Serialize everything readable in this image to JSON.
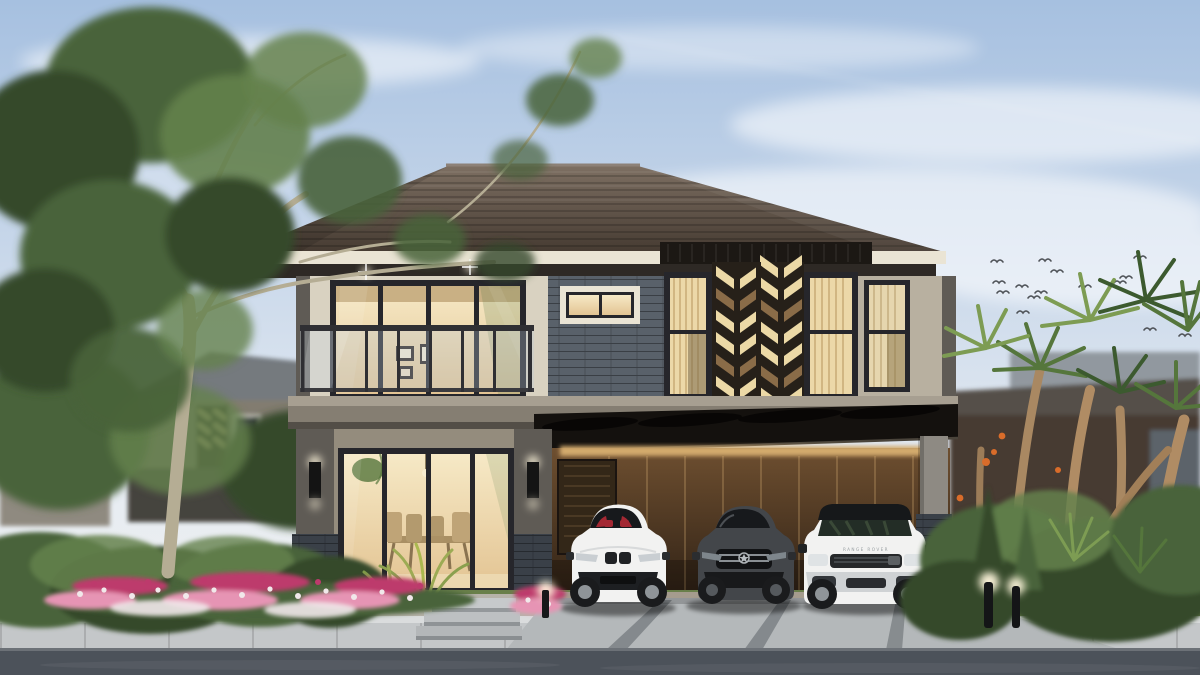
{
  "scene": {
    "subject": "two-story modern house exterior with triple carport",
    "sky": {
      "birds_count": 15,
      "clouds": "thin high streaks"
    },
    "house": {
      "roof": "dark brown hipped roof with cream fascia",
      "facade_features": [
        "upper balcony with glass railing and warm-lit sliding doors",
        "gray stacked-stone wall section with small lit window",
        "dark wood feature panel with cream chevron pattern",
        "tall warm-lit curtained windows",
        "sloped dark carport canopy with exposed beams",
        "warm brown carport back wall with vertical slats and side door"
      ],
      "lighting": [
        "two ceiling spot sparkles",
        "wall sconces",
        "gold lit strip over carport wall",
        "garden bollard lights"
      ]
    },
    "cars": [
      {
        "name": "white-sports-coupe",
        "color": "white",
        "detail": "red interior visible through windshield"
      },
      {
        "name": "dark-gray-sedan",
        "color": "dark gray",
        "detail": "chrome grille with round badge"
      },
      {
        "name": "white-suv-black-roof",
        "color": "white",
        "hood_text": "RANGE ROVER"
      }
    ],
    "landscape": [
      "large eucalyptus-style tree on left",
      "neighboring houses behind greenery on both sides",
      "pink, magenta and white flower bed",
      "yellow-green spiky shrubs",
      "tropical dracaena palms and conifers on right",
      "gray sidewalk with paver joints and dark asphalt road"
    ]
  },
  "colors": {
    "sky_top": "#a6c0e0",
    "sky_mid": "#cfdcec",
    "sky_low": "#e8edf2",
    "horizon": "#f0efed",
    "cloud": "#ffffff",
    "bird": "#4f5358",
    "roof_hi": "#7d6f62",
    "roof_lo": "#463b32",
    "fascia": "#eae4d4",
    "soffit": "#2e2925",
    "wall_lit": "#d9d2c1",
    "wall_mid": "#b8b0a0",
    "wall_shade": "#948c7d",
    "wall_dark": "#5f5b55",
    "stone_mid": "#59616a",
    "stone_dark": "#3a4048",
    "band_top": "#a79f91",
    "band_face": "#857e72",
    "band_shadow": "#534e47",
    "frame": "#26262b",
    "glass_hi": "#f6e9c6",
    "glass_lo": "#e3c493",
    "curtain": "#ecd8a8",
    "chevron_bg": "#262019",
    "chevron_cream": "#ecd9a6",
    "chevron_tan": "#8a6c48",
    "beam_dark": "#1c1814",
    "carport_hi": "#6e4f30",
    "carport_lo": "#2f2115",
    "carport_glow": "#d3aa6d",
    "canopy": "#14110e",
    "pillar": "#8e8a83",
    "door_wood": "#332718",
    "car_white": "#f2f2f1",
    "car_white_shade": "#cfd2d4",
    "car_dark": "#43464a",
    "car_darker": "#2b2d30",
    "seat_red": "#a32833",
    "tire": "#1a1b1d",
    "rim": "#8f9498",
    "glass_black": "#17191c",
    "suv_glass": "#232d26",
    "grass": "#697f4a",
    "hedge_dark": "#35492c",
    "hedge_mid": "#48633a",
    "hedge_hi": "#64814c",
    "leaf_lime": "#9cab54",
    "fl_magenta": "#bd3a6c",
    "fl_pink": "#e694b4",
    "fl_white": "#f1e8ea",
    "palm_dk": "#3c5a2f",
    "palm_md": "#55763c",
    "palm_hi": "#7d9c53",
    "palm_trunk": "#b08c64",
    "tree_trunk": "#b5ad94",
    "sidewalk_top": "#dadcdd",
    "sidewalk_face": "#c4c7c9",
    "road": "#4c525a",
    "driveway": "#b4b8ba",
    "joint": "#74797d",
    "glow": "#fff6dd"
  }
}
